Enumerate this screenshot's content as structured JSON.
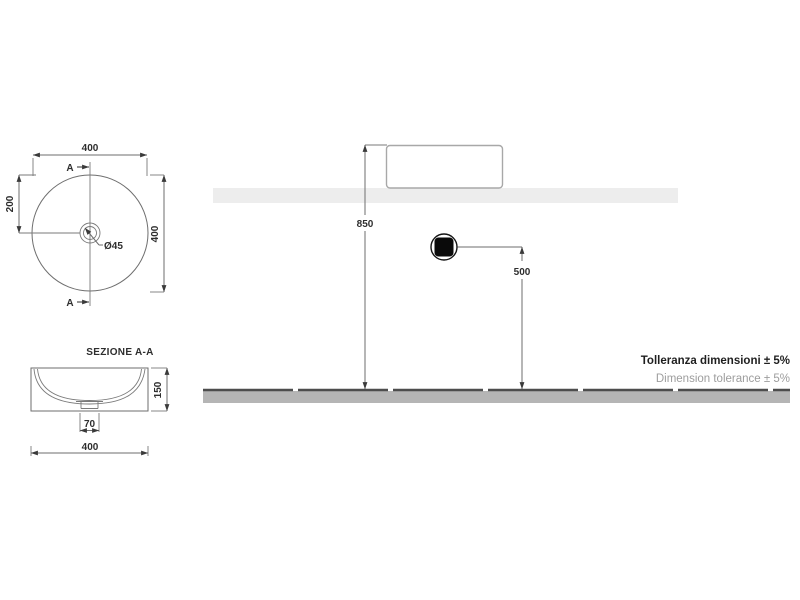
{
  "top_view": {
    "width_label": "400",
    "height_label": "400",
    "center_offset_label": "200",
    "drain_diameter_label": "Ø45",
    "section_marker_top": "A",
    "section_marker_bottom": "A"
  },
  "section_view": {
    "title": "SEZIONE A-A",
    "height_label": "150",
    "drain_width_label": "70",
    "width_label": "400"
  },
  "elevation_view": {
    "rim_height_label": "850",
    "drain_height_label": "500"
  },
  "notes": {
    "tolerance_it": "Tolleranza dimensioni ± 5%",
    "tolerance_en": "Dimension tolerance ± 5%"
  },
  "colors": {
    "line": "#6e6e6e",
    "counter": "#ededed",
    "floor_fill": "#b5b5b5",
    "floor_edge": "#4d4d4d",
    "drain_symbol": "#0a0a0a"
  }
}
